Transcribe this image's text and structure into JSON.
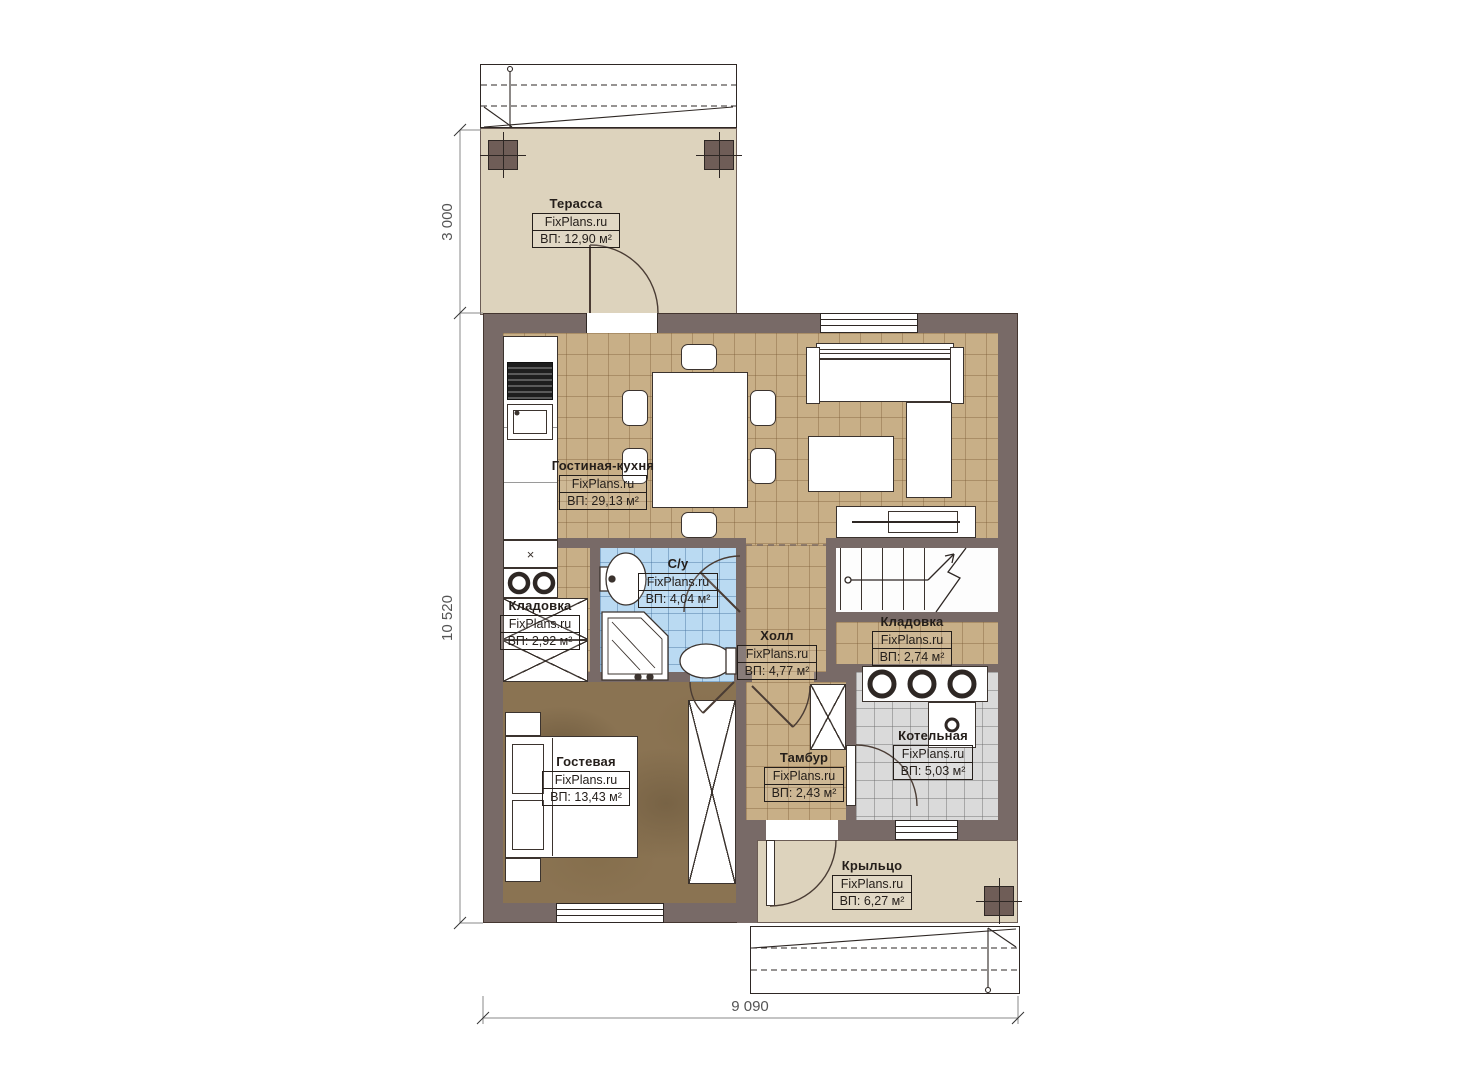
{
  "plan": {
    "brand": "FixPlans.ru"
  },
  "rooms": {
    "terrace": {
      "name": "Терасса",
      "brand": "FixPlans.ru",
      "area": "ВП: 12,90 м²"
    },
    "living_kitchen": {
      "name": "Гостиная-кухня",
      "brand": "FixPlans.ru",
      "area": "ВП: 29,13 м²"
    },
    "bathroom": {
      "name": "С/у",
      "brand": "FixPlans.ru",
      "area": "ВП: 4,04 м²"
    },
    "storage_left": {
      "name": "Кладовка",
      "brand": "FixPlans.ru",
      "area": "ВП: 2,92 м²"
    },
    "hall": {
      "name": "Холл",
      "brand": "FixPlans.ru",
      "area": "ВП: 4,77 м²"
    },
    "storage_right": {
      "name": "Кладовка",
      "brand": "FixPlans.ru",
      "area": "ВП: 2,74 м²"
    },
    "boiler": {
      "name": "Котельная",
      "brand": "FixPlans.ru",
      "area": "ВП: 5,03 м²"
    },
    "vestibule": {
      "name": "Тамбур",
      "brand": "FixPlans.ru",
      "area": "ВП: 2,43 м²"
    },
    "guest": {
      "name": "Гостевая",
      "brand": "FixPlans.ru",
      "area": "ВП: 13,43 м²"
    },
    "porch": {
      "name": "Крыльцо",
      "brand": "FixPlans.ru",
      "area": "ВП: 6,27 м²"
    }
  },
  "dimensions": {
    "terrace_depth": "3 000",
    "house_side": "10 520",
    "house_front": "9 090"
  },
  "colors": {
    "wall": "#786a67",
    "deck_floor": "#ddd3bd",
    "tile_tan": "#c8af87",
    "tile_blue": "#badaf2",
    "tile_gray": "#dadada",
    "guest_floor": "#8a7352",
    "label_ink": "#241e1a",
    "dimension_gray": "#555555"
  }
}
